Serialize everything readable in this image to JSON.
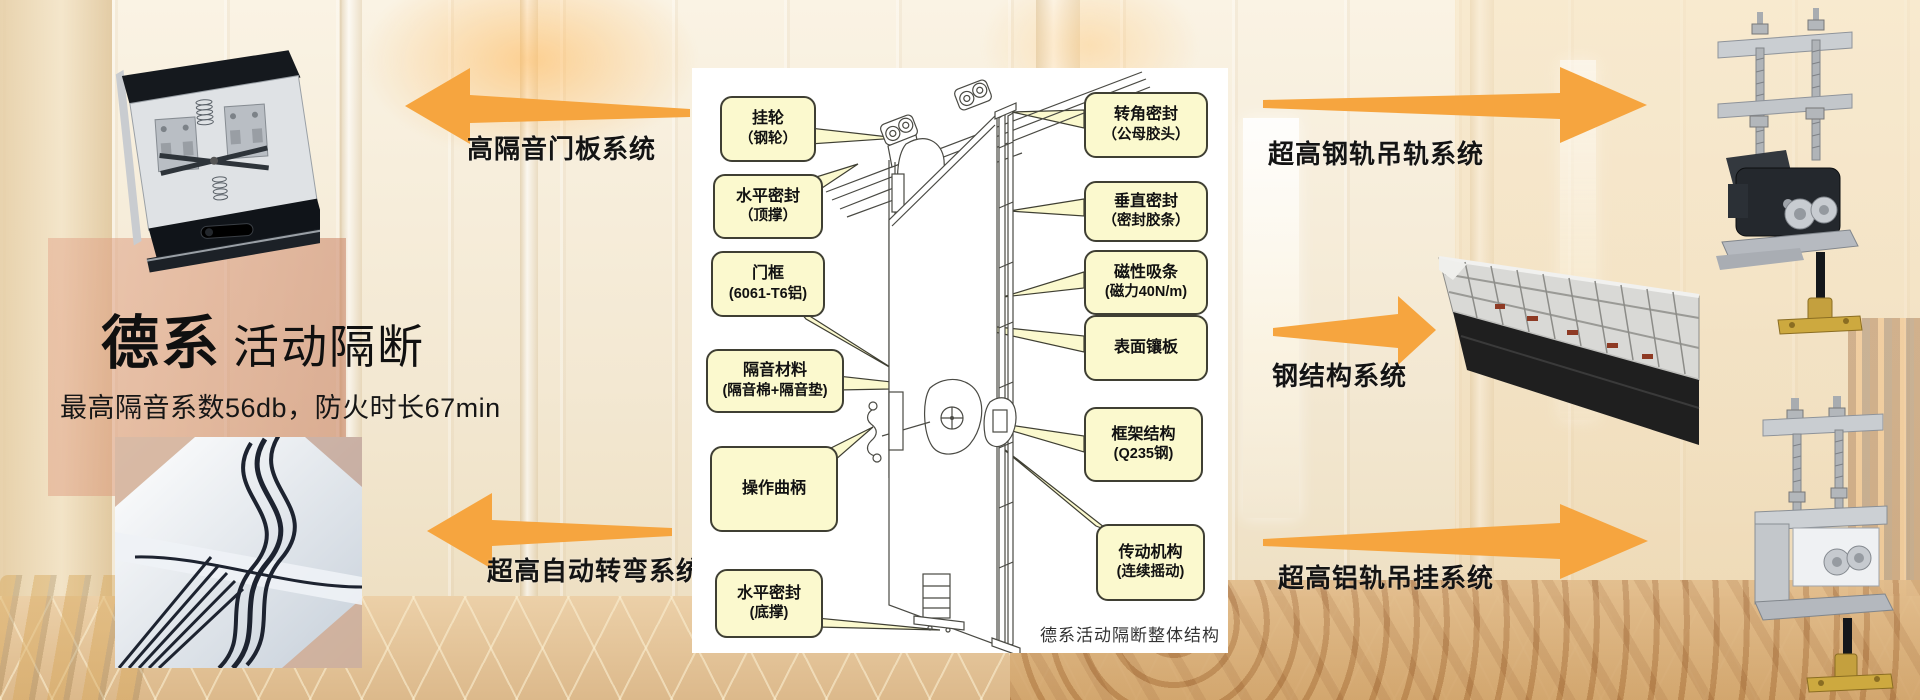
{
  "title": {
    "bold": "德系",
    "regular": "活动隔断",
    "subtitle": "最高隔音系数56db，防火时长67min"
  },
  "system_labels": {
    "door_panel": "高隔音门板系统",
    "auto_turn": "超高自动转弯系统",
    "steel_rail": "超高钢轨吊轨系统",
    "steel_structure": "钢结构系统",
    "alu_rail": "超高铝轨吊挂系统"
  },
  "diagram": {
    "caption": "德系活动隔断整体结构",
    "callouts": [
      {
        "id": "hanging-wheel",
        "lines": [
          "挂轮",
          "（钢轮）"
        ]
      },
      {
        "id": "horizontal-seal-top",
        "lines": [
          "水平密封",
          "（顶撑）"
        ]
      },
      {
        "id": "door-frame",
        "lines": [
          "门框",
          "(6061-T6铝)"
        ]
      },
      {
        "id": "sound-insulation",
        "lines": [
          "隔音材料",
          "(隔音棉+隔音垫)"
        ]
      },
      {
        "id": "operating-crank",
        "lines": [
          "操作曲柄"
        ]
      },
      {
        "id": "horizontal-seal-bottom",
        "lines": [
          "水平密封",
          "(底撑)"
        ]
      },
      {
        "id": "corner-seal",
        "lines": [
          "转角密封",
          "（公母胶头）"
        ]
      },
      {
        "id": "vertical-seal",
        "lines": [
          "垂直密封",
          "（密封胶条）"
        ]
      },
      {
        "id": "magnetic-strip",
        "lines": [
          "磁性吸条",
          "(磁力40N/m)"
        ]
      },
      {
        "id": "surface-panel",
        "lines": [
          "表面镶板"
        ]
      },
      {
        "id": "frame-structure",
        "lines": [
          "框架结构",
          "(Q235钢)"
        ]
      },
      {
        "id": "transmission",
        "lines": [
          "传动机构",
          "(连续摇动)"
        ]
      }
    ]
  },
  "colors": {
    "arrow": "#F6A53F",
    "callout_bg": "#FBF9CE",
    "callout_border": "#3F3F33",
    "panel_bg": "#FFFFFF",
    "label_text": "#141414"
  }
}
